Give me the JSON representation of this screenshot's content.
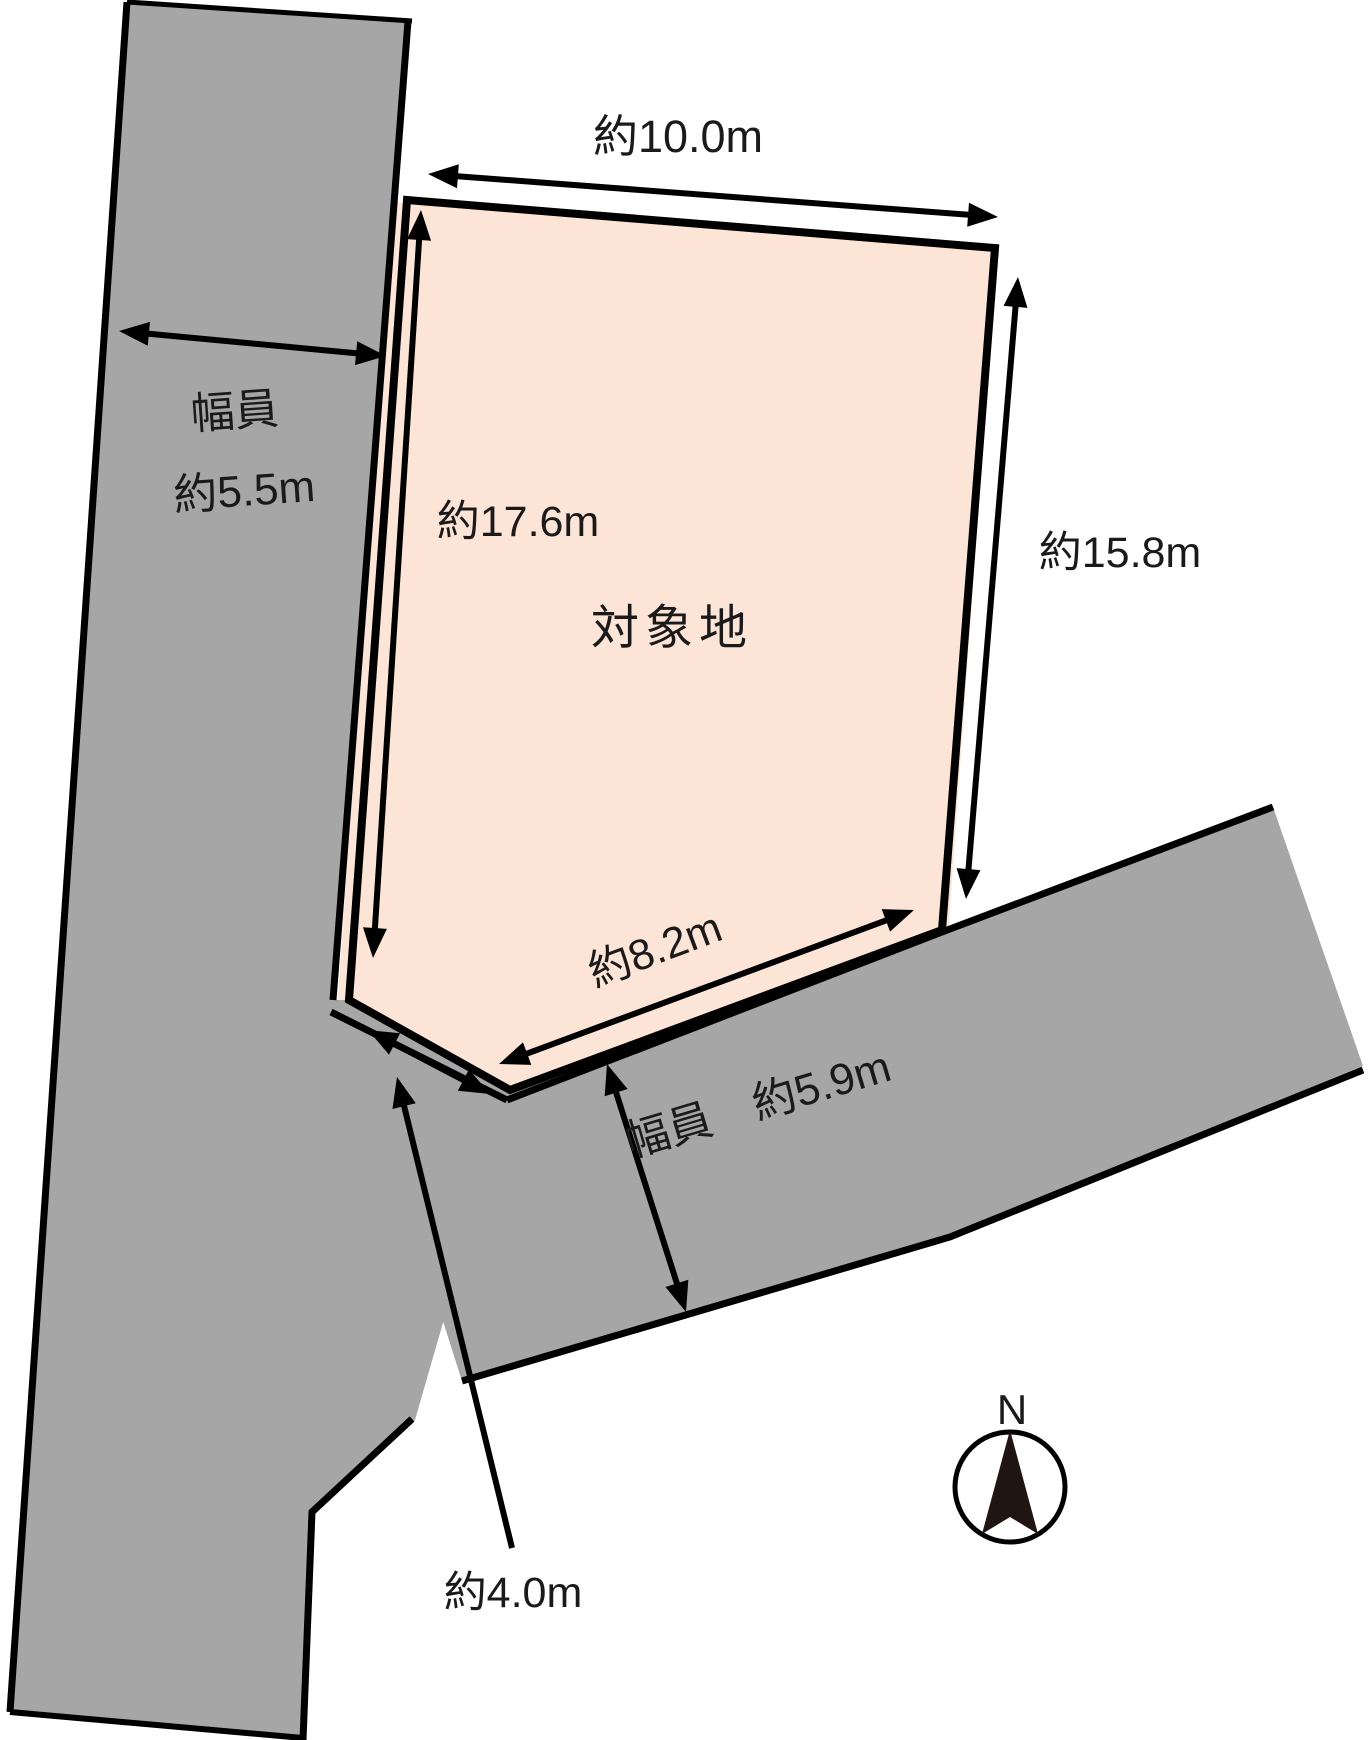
{
  "diagram": {
    "site": {
      "label": "対象地",
      "fill": "#fce4d6"
    },
    "dimensions": {
      "top_width": "約10.0m",
      "west_depth": "約17.6m",
      "east_depth": "約15.8m",
      "south_width": "約8.2m",
      "corner_cut": "約4.0m"
    },
    "roads": {
      "west_road": {
        "caption_line1": "幅員",
        "caption_line2": "約5.5m",
        "fill": "#a6a6a6"
      },
      "south_road": {
        "caption": "幅員　約5.9m",
        "fill": "#a6a6a6"
      }
    },
    "compass": {
      "label": "N",
      "needle_color": "#211512"
    },
    "line_color": "#000000"
  }
}
